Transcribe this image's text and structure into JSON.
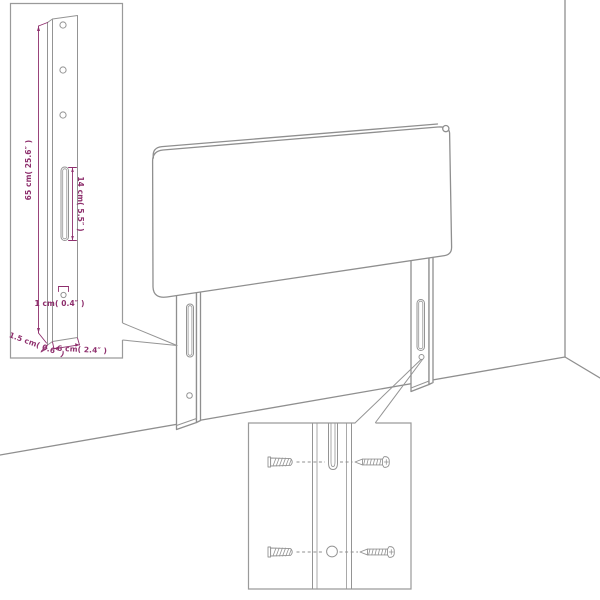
{
  "colors": {
    "background": "#ffffff",
    "outline_gray": "#8f8f8f",
    "dimension_magenta": "#8e2f6d"
  },
  "leg_detail_inset": {
    "height_label": "65 cm( 25.6″ )",
    "slot_label": "14 cm( 5.5″ )",
    "hole_label": "1 cm( 0.4″ )",
    "depth_label": "1.5 cm( 0.6″ )",
    "width_label": "6 cm( 2.4″ )"
  }
}
